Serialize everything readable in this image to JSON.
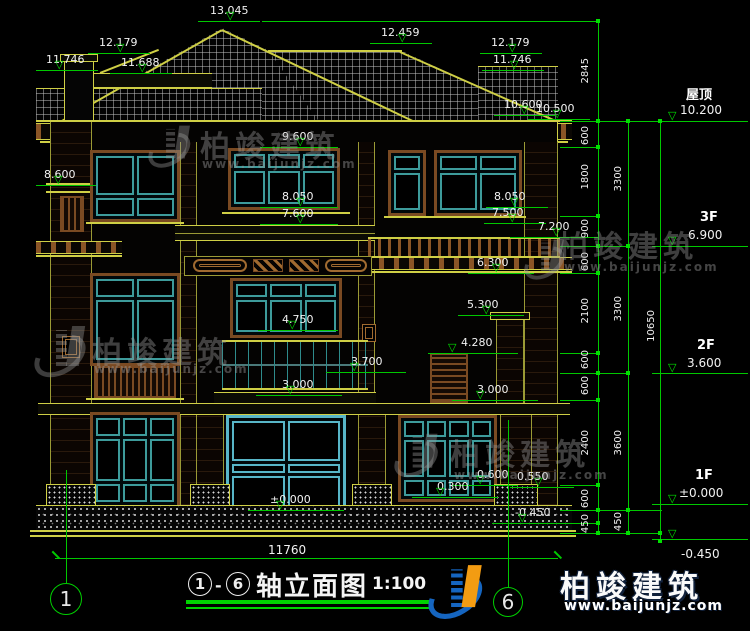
{
  "brand": {
    "name": "柏竣建筑",
    "url": "www.baijunjz.com"
  },
  "title": {
    "circle_from": "1",
    "circle_to": "6",
    "dash": "-",
    "name": "轴立面图",
    "scale": "1:100",
    "axis_bubble_left": "1",
    "axis_bubble_right": "6"
  },
  "bottom_dim": "11760",
  "levels": [
    {
      "t": "13.045",
      "x": 210,
      "y": 5,
      "lx": 198,
      "lw": 62,
      "ly": 21,
      "rx": 226
    },
    {
      "t": "12.459",
      "x": 381,
      "y": 27,
      "lx": 370,
      "lw": 62,
      "ly": 43,
      "rx": 398
    },
    {
      "t": "12.179",
      "x": 99,
      "y": 37,
      "lx": 88,
      "lw": 62,
      "ly": 53,
      "rx": 116
    },
    {
      "t": "11.746",
      "x": 46,
      "y": 54,
      "lx": 36,
      "lw": 62,
      "ly": 70,
      "rx": 55
    },
    {
      "t": "11.688",
      "x": 121,
      "y": 57,
      "lx": 110,
      "lw": 62,
      "ly": 73,
      "rx": 138
    },
    {
      "t": "12.179",
      "x": 491,
      "y": 37,
      "lx": 480,
      "lw": 62,
      "ly": 53,
      "rx": 508
    },
    {
      "t": "11.746",
      "x": 493,
      "y": 54,
      "lx": 482,
      "lw": 62,
      "ly": 70,
      "rx": 510
    },
    {
      "t": "10.600",
      "x": 504,
      "y": 99,
      "lx": 494,
      "lw": 62,
      "ly": 115,
      "rx": 520
    },
    {
      "t": "10.500",
      "x": 536,
      "y": 103,
      "lx": 528,
      "lw": 62,
      "ly": 119,
      "rx": 553
    },
    {
      "t": "8.600",
      "x": 44,
      "y": 169,
      "lx": 36,
      "lw": 60,
      "ly": 185,
      "rx": 54
    },
    {
      "t": "9.600",
      "x": 282,
      "y": 131,
      "lx": 260,
      "lw": 78,
      "ly": 147,
      "rx": 296
    },
    {
      "t": "8.050",
      "x": 282,
      "y": 191,
      "lx": 260,
      "lw": 78,
      "ly": 207,
      "rx": 296
    },
    {
      "t": "7.600",
      "x": 282,
      "y": 208,
      "lx": 260,
      "lw": 78,
      "ly": 224,
      "rx": 296
    },
    {
      "t": "8.050",
      "x": 494,
      "y": 191,
      "lx": 486,
      "lw": 62,
      "ly": 207,
      "rx": 510
    },
    {
      "t": "7.500",
      "x": 492,
      "y": 207,
      "lx": 484,
      "lw": 62,
      "ly": 223,
      "rx": 508
    },
    {
      "t": "7.200",
      "x": 538,
      "y": 221,
      "lx": 510,
      "lw": 88,
      "ly": 237,
      "rx": 552
    },
    {
      "t": "6.300",
      "x": 477,
      "y": 257,
      "lx": 468,
      "lw": 66,
      "ly": 273,
      "rx": 492
    },
    {
      "t": "5.300",
      "x": 467,
      "y": 299,
      "lx": 458,
      "lw": 66,
      "ly": 315,
      "rx": 482
    },
    {
      "t": "4.280",
      "x": 461,
      "y": 337,
      "lx": 428,
      "lw": 90,
      "ly": 353,
      "rx": 448
    },
    {
      "t": "4.750",
      "x": 282,
      "y": 314,
      "lx": 258,
      "lw": 80,
      "ly": 330,
      "rx": 288
    },
    {
      "t": "3.700",
      "x": 351,
      "y": 356,
      "lx": 326,
      "lw": 80,
      "ly": 372,
      "rx": 350
    },
    {
      "t": "3.000",
      "x": 282,
      "y": 379,
      "lx": 256,
      "lw": 86,
      "ly": 395,
      "rx": 286
    },
    {
      "t": "3.000",
      "x": 477,
      "y": 384,
      "lx": 452,
      "lw": 86,
      "ly": 400,
      "rx": 476
    },
    {
      "t": "0.600",
      "x": 477,
      "y": 469,
      "lx": 452,
      "lw": 66,
      "ly": 485,
      "rx": 476
    },
    {
      "t": "0.550",
      "x": 517,
      "y": 471,
      "lx": 510,
      "lw": 64,
      "ly": 487,
      "rx": 534
    },
    {
      "t": "0.300",
      "x": 437,
      "y": 481,
      "lx": 412,
      "lw": 86,
      "ly": 497,
      "rx": 436
    },
    {
      "t": "±0.000",
      "x": 270,
      "y": 494,
      "lx": 248,
      "lw": 96,
      "ly": 510,
      "rx": 276
    },
    {
      "t": "-0.450",
      "x": 515,
      "y": 507,
      "lx": 492,
      "lw": 76,
      "ly": 523,
      "rx": 518
    }
  ],
  "right_levels": [
    {
      "tag": "屋顶",
      "tx": 686,
      "ty": 84,
      "val": "10.200",
      "vx": 680,
      "vy": 103,
      "ly": 121
    },
    {
      "tag": "3F",
      "tx": 700,
      "ty": 210,
      "val": "6.900",
      "vx": 688,
      "vy": 228,
      "ly": 246
    },
    {
      "tag": "2F",
      "tx": 697,
      "ty": 338,
      "val": "3.600",
      "vx": 687,
      "vy": 356,
      "ly": 373
    },
    {
      "tag": "1F",
      "tx": 695,
      "ty": 468,
      "val": "±0.000",
      "vx": 679,
      "vy": 486,
      "ly": 504
    },
    {
      "tag": "",
      "tx": 681,
      "ty": 560,
      "val": "-0.450",
      "vx": 681,
      "vy": 547,
      "ly": 539
    }
  ],
  "dims": [
    {
      "t": "2845",
      "x": 580,
      "y": 58
    },
    {
      "t": "600",
      "x": 580,
      "y": 126
    },
    {
      "t": "1800",
      "x": 580,
      "y": 164
    },
    {
      "t": "900",
      "x": 580,
      "y": 219
    },
    {
      "t": "600",
      "x": 580,
      "y": 252
    },
    {
      "t": "2100",
      "x": 580,
      "y": 298
    },
    {
      "t": "600",
      "x": 580,
      "y": 350
    },
    {
      "t": "600",
      "x": 580,
      "y": 376
    },
    {
      "t": "2400",
      "x": 580,
      "y": 430
    },
    {
      "t": "600",
      "x": 580,
      "y": 489
    },
    {
      "t": "450",
      "x": 580,
      "y": 514
    },
    {
      "t": "3300",
      "x": 613,
      "y": 166
    },
    {
      "t": "3300",
      "x": 613,
      "y": 296
    },
    {
      "t": "3600",
      "x": 613,
      "y": 430
    },
    {
      "t": "450",
      "x": 613,
      "y": 512
    },
    {
      "t": "10650",
      "x": 646,
      "y": 310
    }
  ]
}
